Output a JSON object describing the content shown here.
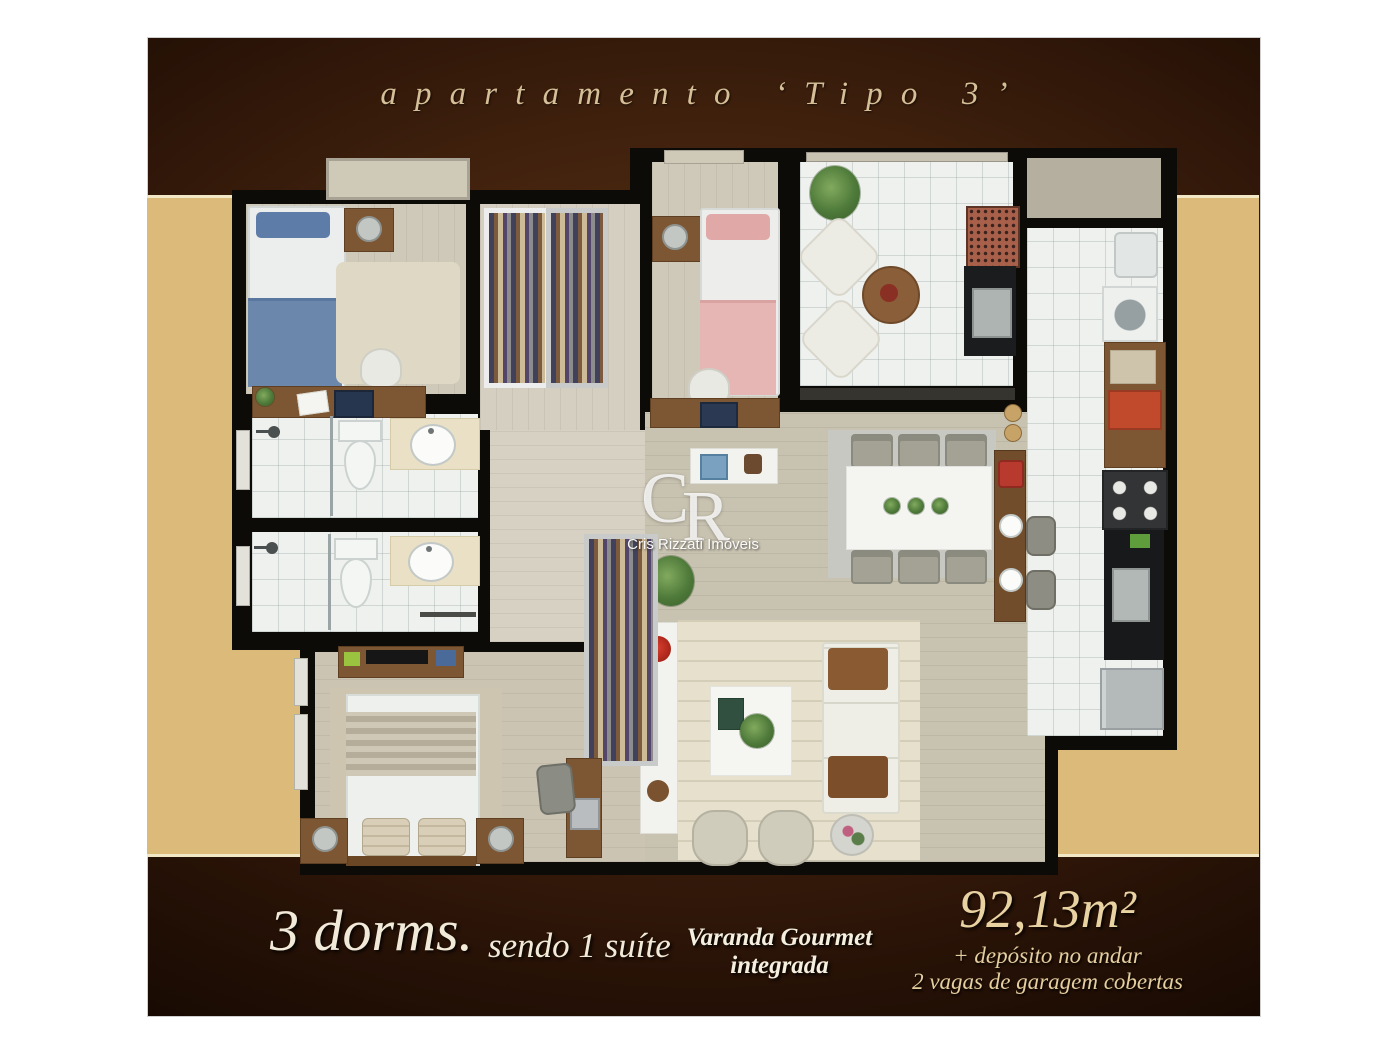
{
  "title": "apartamento ‘Tipo 3’",
  "watermark": {
    "initial_c": "C",
    "initial_r": "R",
    "name": "Cris Rizzati Imóveis"
  },
  "footer": {
    "dorms_big": "3 dorms.",
    "dorms_small": "sendo 1 suíte",
    "varanda_line1": "Varanda Gourmet",
    "varanda_line2": "integrada",
    "area": "92,13m²",
    "extra_line1": "+ depósito no andar",
    "extra_line2": "2 vagas de garagem cobertas"
  },
  "colors": {
    "page_background": "#ffffff",
    "poster_brown_dark": "#2a1307",
    "poster_brown_light": "#5c3620",
    "band_tan": "#dcba79",
    "band_edge_cream": "#f3e8c6",
    "wall_black": "#0d0b08",
    "floor_wood": "#cfc9b9",
    "floor_tile": "#eff1ee",
    "accent_cream_text": "#e9d2a2"
  },
  "floorplan": {
    "rooms": [
      "bedroom-1",
      "bedroom-2",
      "closet-area",
      "bathroom-1",
      "bathroom-2",
      "hall",
      "master-suite",
      "living-room",
      "dining-area",
      "gourmet-balcony",
      "kitchen",
      "service-area"
    ]
  }
}
